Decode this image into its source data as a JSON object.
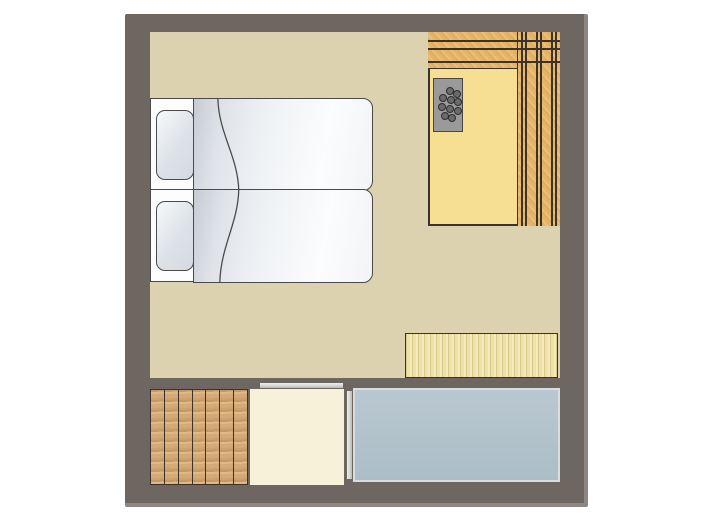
{
  "scene": {
    "type": "floor-plan",
    "description": "top-down-lodge-floor-plan"
  },
  "colors": {
    "page_bg": "#ffffff",
    "wall": "#6e6661",
    "wall_edge": "#8d8784",
    "floor_main": "#dcd2b0",
    "sauna_floor": "#f6de92",
    "sauna_bench": "#e6b465",
    "outline_dark": "#3b332b",
    "bed_outline": "#4a4a4a",
    "bed_fill": "#fdfdfd",
    "duvet_shade": "#c6ccd3",
    "pillow_shade": "#dde2e7",
    "heater_body": "#9a9a9a",
    "heater_stone": "#6b6b6b",
    "bench_wood": "#efe2a9",
    "deck_wood": "#d5aa76",
    "entry_floor": "#f8f1da",
    "blue_floor": "#b2c2cb",
    "blue_floor_edge": "#d8dde0",
    "door_bar": "#d6d6d6"
  },
  "components": {
    "bedroom": {
      "label": "bedroom-area",
      "beds": 2,
      "pillows": 2
    },
    "sauna": {
      "label": "sauna-area",
      "heater_stones": 10,
      "top_bench_boards": 4,
      "side_bench_boards": 3
    },
    "heater": {
      "label": "sauna-heater"
    },
    "sideboard": {
      "label": "wooden-bench"
    },
    "deck": {
      "label": "wood-deck",
      "planks": 7
    },
    "entry": {
      "label": "entry-area"
    },
    "blue_area": {
      "label": "veranda-area"
    },
    "doors": {
      "label": "sliding-door",
      "count": 2
    }
  }
}
